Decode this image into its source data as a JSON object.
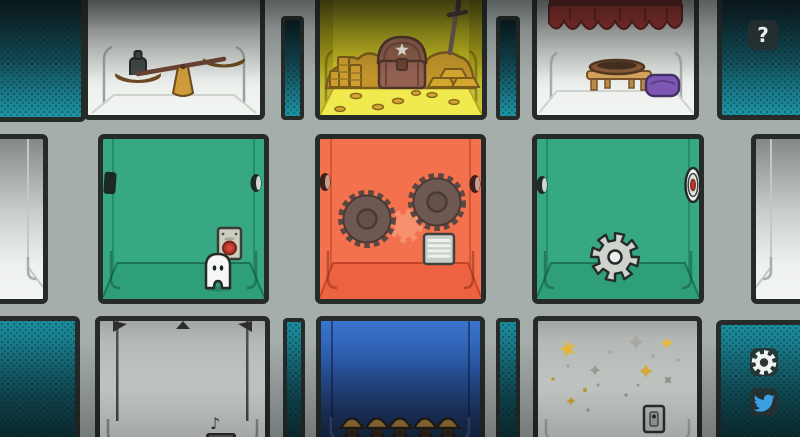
{
  "scene": {
    "name": "room-grid-puzzle-screen",
    "rooms": [
      {
        "id": "scales",
        "row": "top",
        "wall_color": "#eef1ee",
        "contents": "balance-scale-with-weight"
      },
      {
        "id": "treasure",
        "row": "top",
        "wall_color": "#efe94e",
        "contents": "gold-pile-treasure-chest-sword-coins"
      },
      {
        "id": "curtain",
        "row": "top",
        "wall_color": "#eef1ee",
        "contents": "red-curtain-low-table-bowl-purple-cushion"
      },
      {
        "id": "ghost",
        "row": "middle",
        "wall_color": "#36a884",
        "contents": "white-ghost-and-red-button-panel"
      },
      {
        "id": "saws",
        "row": "middle",
        "wall_color": "#f4714e",
        "contents": "two-saw-blades-gear-imprint-vent"
      },
      {
        "id": "gear",
        "row": "middle",
        "wall_color": "#36a884",
        "contents": "gray-gear-and-wall-target"
      },
      {
        "id": "hooks",
        "row": "bottom",
        "wall_color": "#eef1ee",
        "contents": "ceiling-hooks-rods-music-note"
      },
      {
        "id": "crowd",
        "row": "bottom",
        "wall_color": "#2b5cae",
        "contents": "five-figures-in-conical-hats"
      },
      {
        "id": "stars",
        "row": "bottom",
        "wall_color": "#eff2ef",
        "contents": "scattered-stars-and-light-switch"
      }
    ],
    "music_note_glyph": "♪"
  },
  "ui": {
    "help_button": {
      "label": "?",
      "icon": "question-mark-icon"
    },
    "settings_button": {
      "icon": "gear-icon"
    },
    "twitter_button": {
      "icon": "twitter-bird-icon",
      "accent": "#3b9fe2"
    }
  },
  "colors": {
    "background_gray": "#a6aeac",
    "outline": "#262b29",
    "teal_bright": "#1e97a8",
    "teal_dark": "#0b323a",
    "green_room": "#36a884",
    "orange_room": "#f4714e",
    "blue_room": "#2b5cae",
    "treasure_yellow": "#efe94e",
    "gold": "#c2952a",
    "curtain_red": "#8c2e2a",
    "cushion_purple": "#7e57b5",
    "button_red": "#b8372a"
  }
}
